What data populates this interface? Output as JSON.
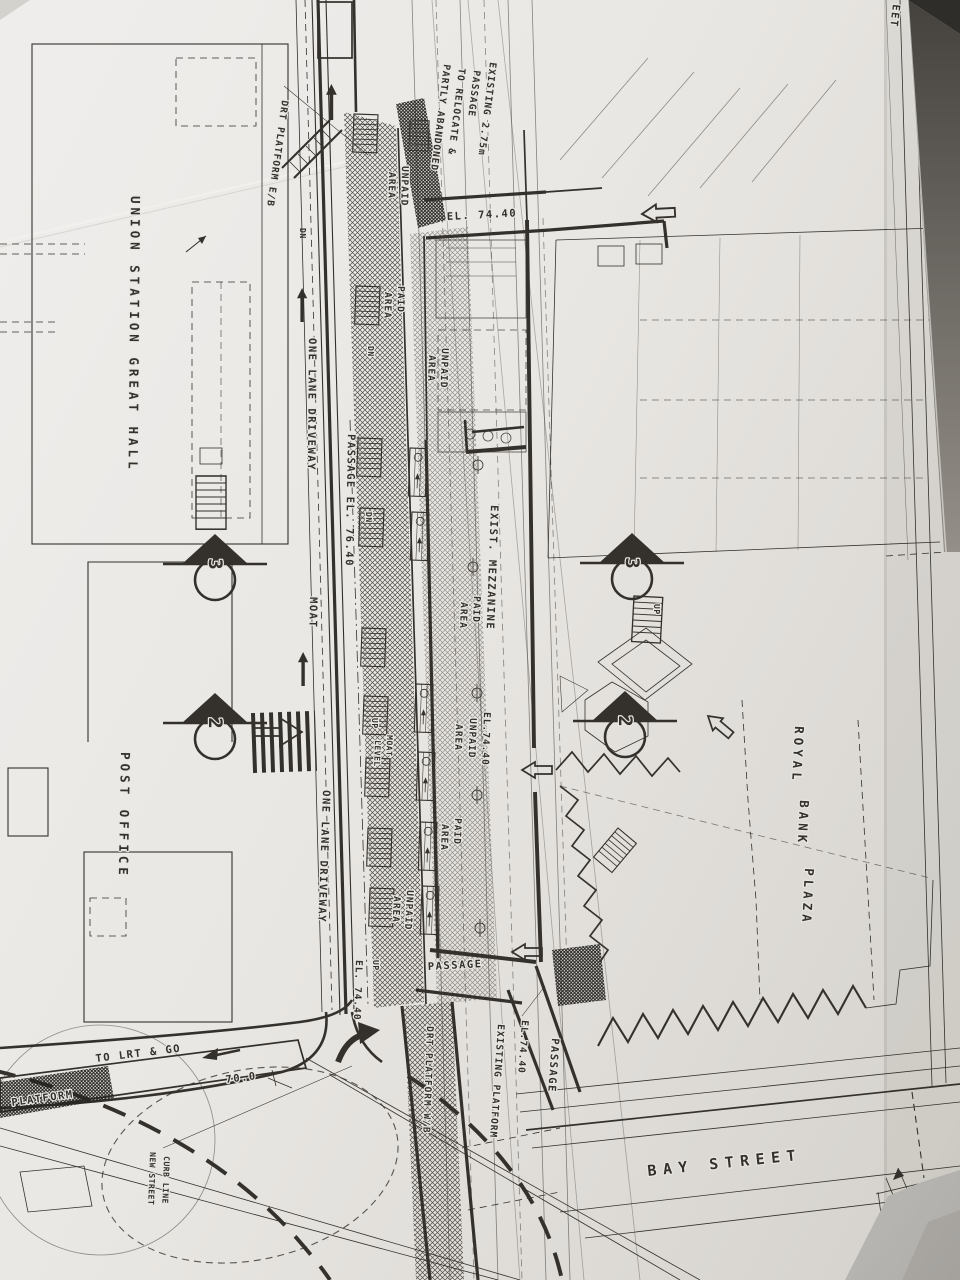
{
  "photo": {
    "paper_color": "#e9e7e3",
    "ink_color": "#34312c",
    "shadow_color": "#b7b5b1",
    "corner_dark_color": "#2f2d2a"
  },
  "plan": {
    "buildings": {
      "union_station": "UNION STATION GREAT HALL",
      "post_office": "POST OFFICE",
      "royal": "ROYAL",
      "bank": "BANK",
      "plaza": "PLAZA"
    },
    "streets": {
      "bay_street": "BAY STREET",
      "street_edge_partial": "EET",
      "new_street_line1": "NEW STREET",
      "new_street_line2": "CURB LINE"
    },
    "transit": {
      "drt_platform_eb": "DRT PLATFORM E/B",
      "drt_platform_wb": "DRT PLATFORM W/B",
      "existing_platform": "EXISTING PLATFORM",
      "platform_edge": "PLATFORM",
      "to_lrt_and_go": "TO LRT & GO"
    },
    "areas": {
      "unpaid": "UNPAID",
      "paid": "PAID",
      "area": "AREA",
      "exist_mezzanine": "EXIST. MEZZANINE",
      "moat": "MOAT",
      "moat_level_line1": "MOAT",
      "moat_level_line2": "LEVEL",
      "one_lane_driveway": "ONE LANE DRIVEWAY",
      "passage": "PASSAGE",
      "passage_el_76_40": "PASSAGE  EL. 76.40"
    },
    "note_existing_passage": {
      "line1": "EXISTING  2.75m",
      "line2": "PASSAGE",
      "line3": "TO RELOCATE &",
      "line4": "PARTLY ABANDONED"
    },
    "elevations": {
      "el_74_40": "EL. 74.40",
      "el_74_40_compact": "EL.74.40"
    },
    "dimensions": {
      "curb_radius": "70.0",
      "offset_400": "4.00±"
    },
    "stair_labels": {
      "up": "UP",
      "dn": "DN"
    },
    "section_markers": {
      "section_2": "2",
      "section_3": "3"
    }
  }
}
